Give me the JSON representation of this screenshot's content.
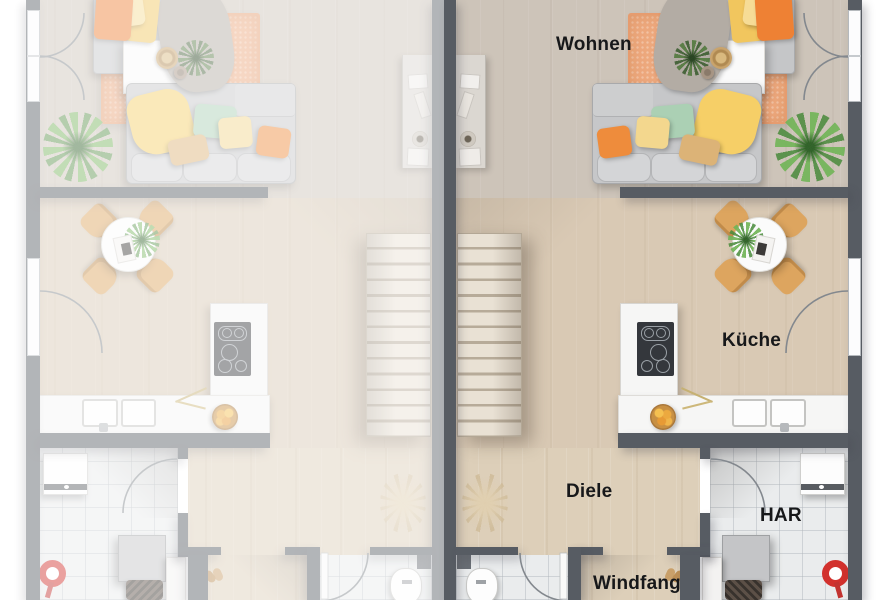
{
  "labels": {
    "living": "Wohnen",
    "kitchen": "Küche",
    "hall": "Diele",
    "vestibule": "Windfang",
    "utility": "HAR"
  },
  "colors": {
    "wall": "#575c63",
    "floor_wood": "#d6cbbd",
    "floor_wood_warm": "#ddcfb9",
    "tile": "#eaeced",
    "rug_orange": "#eda87d",
    "pillow_orange": "#ee8134",
    "pillow_yellow": "#f1c65e",
    "pillow_green": "#abd0b4",
    "pillow_tan": "#dcb377",
    "sofa_gray": "#c6c7c9",
    "chair_tan": "#dda55f",
    "plant_green": "#6fae53",
    "vacuum_red": "#d2312d",
    "counter_white": "#f6f6f5",
    "cooktop_black": "#34373c"
  },
  "units": {
    "right": {
      "state": "active",
      "rooms": [
        "Wohnen",
        "Küche",
        "Diele",
        "Windfang",
        "HAR",
        "Bad"
      ]
    },
    "left": {
      "state": "faded mirror copy",
      "rooms": []
    }
  }
}
